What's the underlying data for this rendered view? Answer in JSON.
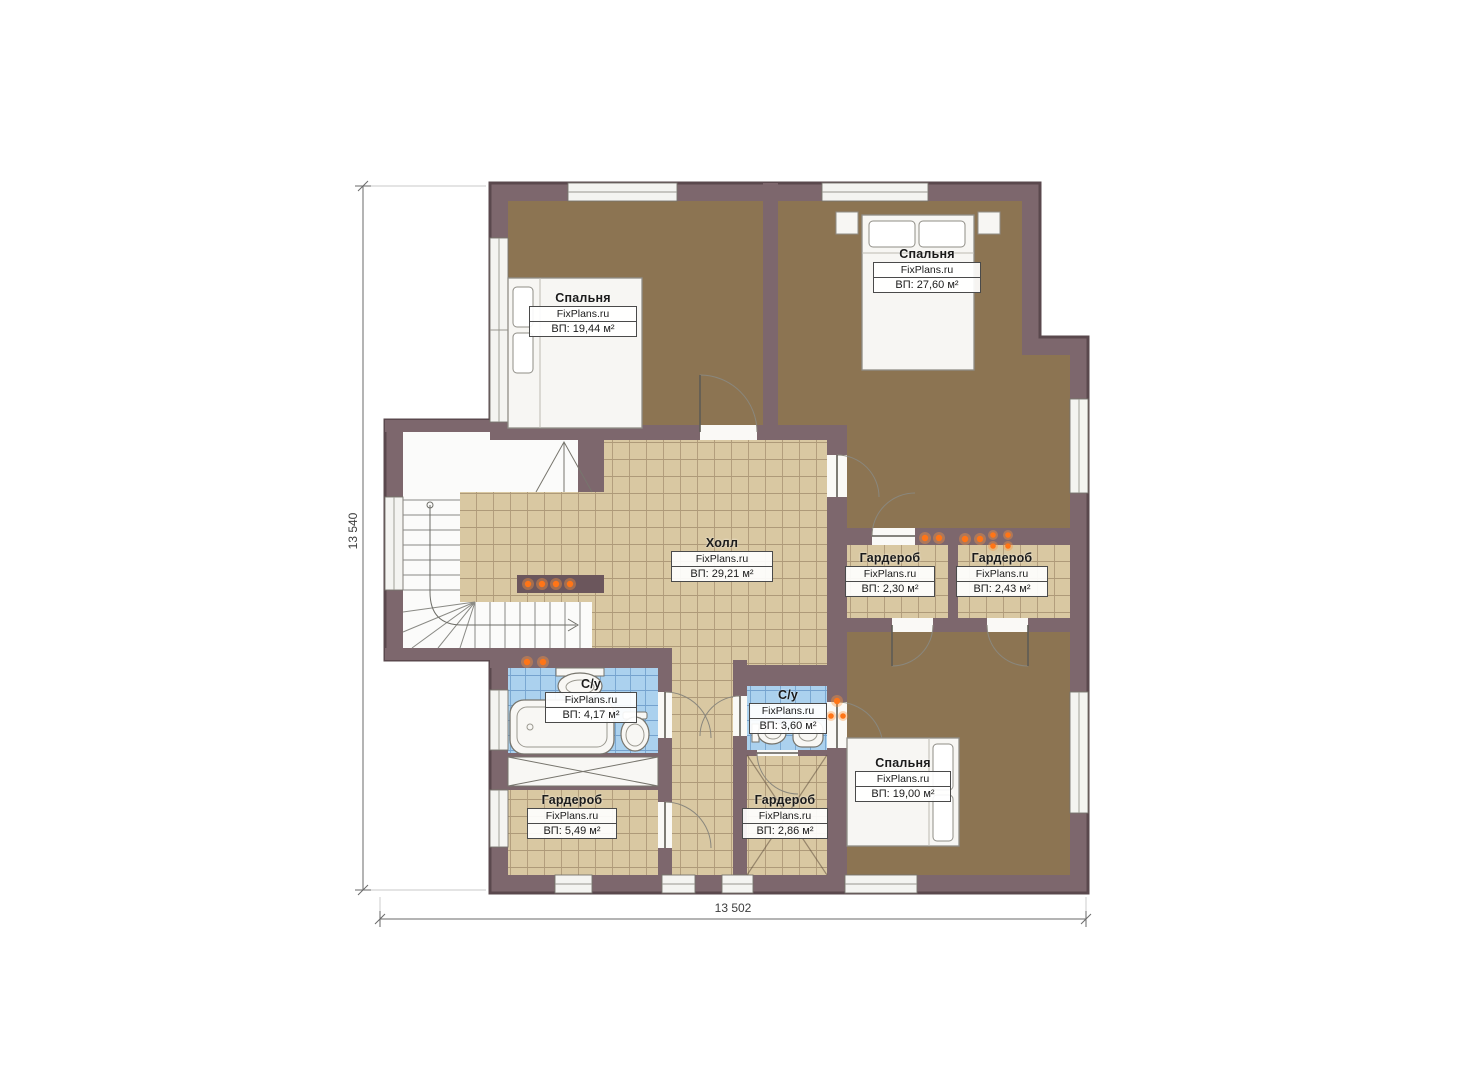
{
  "watermark": "FixPlans.ru",
  "dimensions": {
    "left_vertical": "13 540",
    "bottom_horizontal": "13 502"
  },
  "rooms": [
    {
      "id": "bedroom-top-left",
      "name": "Спальня",
      "site": "FixPlans.ru",
      "area": "ВП: 19,44 м²"
    },
    {
      "id": "bedroom-top-right",
      "name": "Спальня",
      "site": "FixPlans.ru",
      "area": "ВП: 27,60 м²"
    },
    {
      "id": "hall",
      "name": "Холл",
      "site": "FixPlans.ru",
      "area": "ВП: 29,21 м²"
    },
    {
      "id": "wardrobe-1",
      "name": "Гардероб",
      "site": "FixPlans.ru",
      "area": "ВП: 2,30 м²"
    },
    {
      "id": "wardrobe-2",
      "name": "Гардероб",
      "site": "FixPlans.ru",
      "area": "ВП: 2,43 м²"
    },
    {
      "id": "bathroom-1",
      "name": "С/у",
      "site": "FixPlans.ru",
      "area": "ВП: 4,17 м²"
    },
    {
      "id": "bathroom-2",
      "name": "С/у",
      "site": "FixPlans.ru",
      "area": "ВП: 3,60 м²"
    },
    {
      "id": "bedroom-bottom-right",
      "name": "Спальня",
      "site": "FixPlans.ru",
      "area": "ВП: 19,00 м²"
    },
    {
      "id": "wardrobe-3",
      "name": "Гардероб",
      "site": "FixPlans.ru",
      "area": "ВП: 5,49 м²"
    },
    {
      "id": "wardrobe-4",
      "name": "Гардероб",
      "site": "FixPlans.ru",
      "area": "ВП: 2,86 м²"
    }
  ],
  "colors": {
    "wall": "#7d676d",
    "wall_outline": "#5a484d",
    "bedroom_floor": "#8c7452",
    "tile_floor": "#d9c8a2",
    "tile_grid": "#a08a6a",
    "bath_tile": "#abd1ee",
    "bath_grid": "#6f9ecb",
    "fixture": "#f8f7f4",
    "spotlight": "#ff7517",
    "dimension_line": "#6a6a6a"
  }
}
